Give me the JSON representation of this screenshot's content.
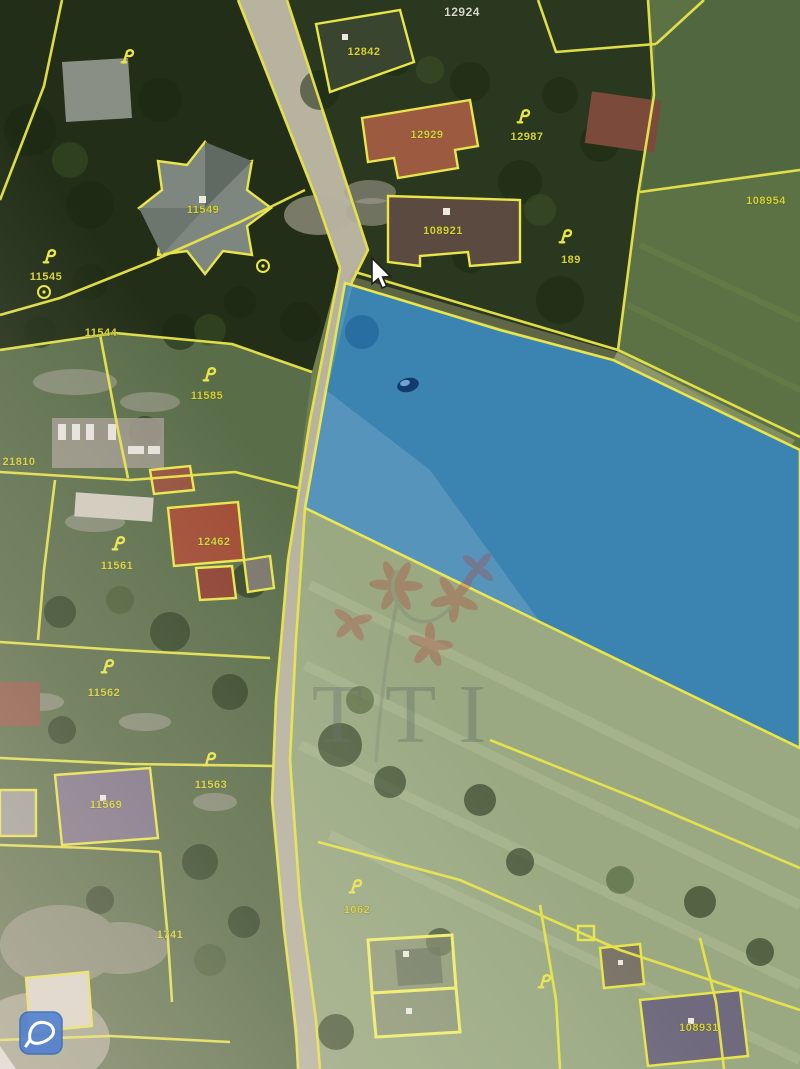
{
  "app": {
    "title": "Cadastral parcel map – aerial view"
  },
  "map": {
    "colors": {
      "parcel_line": "#e9e54a",
      "label": "#d6d23b",
      "selected_fill": "#2e85c7",
      "selected_stroke": "#e9e54a"
    },
    "selected_parcel": {
      "points": "345,283 500,330 613,360 800,450 800,748 540,622 305,508 326,390",
      "fill_opacity": "0.8"
    },
    "labels": [
      {
        "text": "12924",
        "x": 462,
        "y": 16,
        "light": true
      },
      {
        "text": "12842",
        "x": 364,
        "y": 55
      },
      {
        "text": "12929",
        "x": 427,
        "y": 138
      },
      {
        "text": "12987",
        "x": 527,
        "y": 140
      },
      {
        "text": "108954",
        "x": 766,
        "y": 204
      },
      {
        "text": "11549",
        "x": 203,
        "y": 213
      },
      {
        "text": "108921",
        "x": 443,
        "y": 234
      },
      {
        "text": "189",
        "x": 571,
        "y": 263
      },
      {
        "text": "11545",
        "x": 46,
        "y": 280
      },
      {
        "text": "11544",
        "x": 101,
        "y": 336
      },
      {
        "text": "11585",
        "x": 207,
        "y": 399
      },
      {
        "text": "21810",
        "x": 19,
        "y": 465
      },
      {
        "text": "12462",
        "x": 214,
        "y": 545
      },
      {
        "text": "11561",
        "x": 117,
        "y": 569
      },
      {
        "text": "11562",
        "x": 104,
        "y": 696
      },
      {
        "text": "11563",
        "x": 211,
        "y": 788
      },
      {
        "text": "11569",
        "x": 106,
        "y": 808
      },
      {
        "text": "1741",
        "x": 170,
        "y": 938
      },
      {
        "text": "1062",
        "x": 357,
        "y": 913
      },
      {
        "text": "108931",
        "x": 699,
        "y": 1031
      }
    ],
    "symbols": [
      {
        "x": 128,
        "y": 58
      },
      {
        "x": 524,
        "y": 118
      },
      {
        "x": 566,
        "y": 238
      },
      {
        "x": 50,
        "y": 258
      },
      {
        "x": 210,
        "y": 376
      },
      {
        "x": 119,
        "y": 545
      },
      {
        "x": 108,
        "y": 668
      },
      {
        "x": 210,
        "y": 761
      },
      {
        "x": 356,
        "y": 888
      },
      {
        "x": 545,
        "y": 983
      }
    ],
    "rings": [
      {
        "x": 44,
        "y": 292
      },
      {
        "x": 263,
        "y": 266
      }
    ]
  },
  "watermark": {
    "text": "TTI"
  },
  "cursor": {
    "x": 372,
    "y": 258
  },
  "toolbar": {
    "area_button_icon": "lasso-polygon-icon"
  }
}
